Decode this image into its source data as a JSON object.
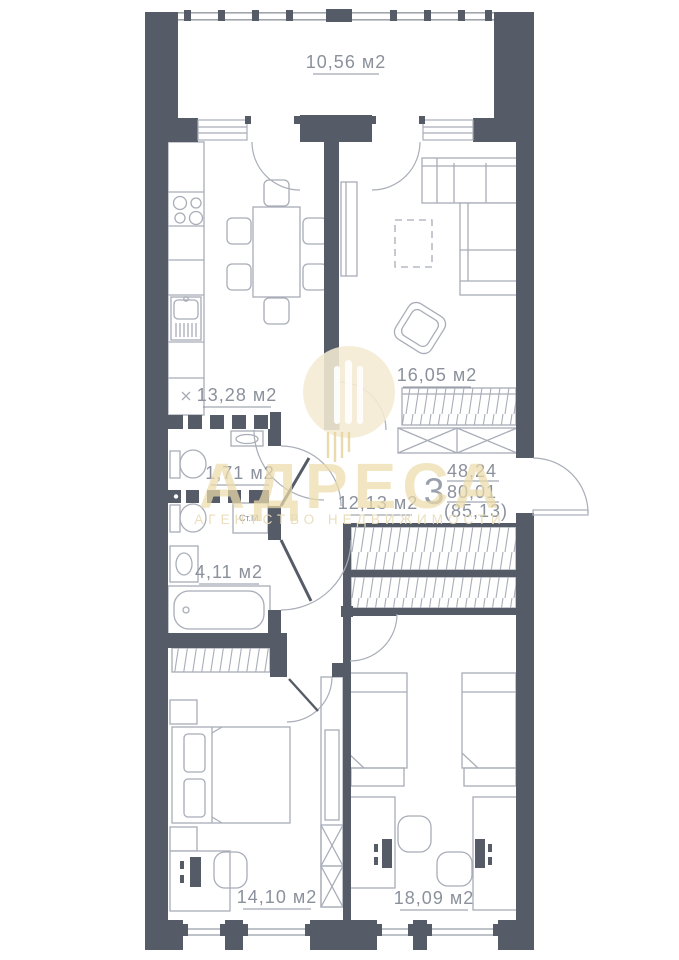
{
  "plan": {
    "balcony": {
      "area": "10,56 м2"
    },
    "kitchen": {
      "area": "13,28 м2"
    },
    "living": {
      "area": "16,05 м2"
    },
    "toilet": {
      "area": "1,71 м2"
    },
    "hallway": {
      "area": "12,13 м2"
    },
    "bathroom": {
      "area": "4,11 м2",
      "washer_label": "Ст.М.",
      "cabinet_mark": "×"
    },
    "bedroom1": {
      "area": "14,10 м2"
    },
    "bedroom2": {
      "area": "18,09 м2"
    },
    "info": {
      "rooms_count": "3",
      "living_area": "48,24",
      "total_area": "80,01",
      "total_with_balcony": "(85,13)"
    },
    "watermark": {
      "title": "АДРЕСА",
      "subtitle": "АГЕНТСТВО НЕДВИЖИМОСТИ"
    },
    "colors": {
      "wall": "#565c67",
      "line": "#a8adb7",
      "text": "#8b919c",
      "watermark_gold": "#ecdcab"
    }
  }
}
